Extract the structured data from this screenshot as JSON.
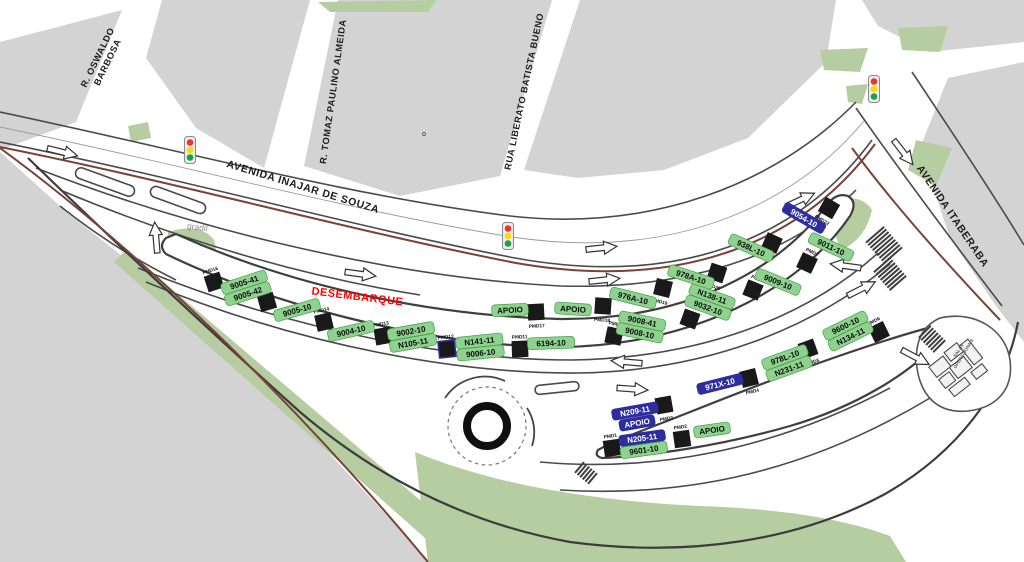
{
  "streets": [
    {
      "id": "oswaldo-barbosa",
      "lines": [
        "R. OSWALDO",
        "BARBOSA"
      ]
    },
    {
      "id": "tomaz-paulino-almeida",
      "lines": [
        "R. TOMAZ PAULINO ALMEIDA"
      ]
    },
    {
      "id": "liberato-batista-bueno",
      "lines": [
        "RUA LIBERATO BATISTA BUENO"
      ]
    },
    {
      "id": "inajar-de-souza",
      "lines": [
        "AVENIDA INAJAR DE SOUZA"
      ]
    },
    {
      "id": "itaberaba",
      "lines": [
        "AVENIDA ITABERABA"
      ]
    }
  ],
  "zones": {
    "desembarque": {
      "label": "DESEMBARQUE",
      "color": "#ff0000"
    },
    "gradil": {
      "label": "gradil"
    },
    "salas_operacionais": {
      "lines": [
        "SALAS",
        "OPERACIONAIS"
      ]
    }
  },
  "platforms": [
    {
      "id": "PMD1",
      "lines": [
        {
          "text": "N205-11",
          "style": "blue"
        },
        {
          "text": "9601-10",
          "style": "green"
        }
      ]
    },
    {
      "id": "PMD2",
      "lines": [
        {
          "text": "APOIO",
          "style": "green"
        }
      ]
    },
    {
      "id": "PMD3",
      "lines": [
        {
          "text": "N209-11",
          "style": "blue"
        },
        {
          "text": "APOIO",
          "style": "blue"
        }
      ]
    },
    {
      "id": "PMD4",
      "lines": [
        {
          "text": "971X-10",
          "style": "blue"
        }
      ]
    },
    {
      "id": "PMD5",
      "lines": [
        {
          "text": "978L-10",
          "style": "green"
        },
        {
          "text": "N231-11",
          "style": "green"
        }
      ]
    },
    {
      "id": "PMD6",
      "lines": [
        {
          "text": "9600-10",
          "style": "green"
        },
        {
          "text": "N134-11",
          "style": "green"
        }
      ]
    },
    {
      "id": "PMD7",
      "lines": [
        {
          "text": "9011-10",
          "style": "green"
        }
      ]
    },
    {
      "id": "PMD8",
      "lines": [
        {
          "text": "9009-10",
          "style": "green"
        }
      ]
    },
    {
      "id": "PMD9",
      "lines": [
        {
          "text": "N138-11",
          "style": "green"
        },
        {
          "text": "9032-10",
          "style": "green"
        }
      ]
    },
    {
      "id": "PMD10",
      "lines": [
        {
          "text": "9008-41",
          "style": "green"
        },
        {
          "text": "9008-10",
          "style": "green"
        }
      ]
    },
    {
      "id": "PMD11",
      "lines": [
        {
          "text": "6194-10",
          "style": "green"
        }
      ]
    },
    {
      "id": "PMD12",
      "frame": "blue",
      "lines": [
        {
          "text": "N141-11",
          "style": "green"
        },
        {
          "text": "9006-10",
          "style": "green"
        }
      ]
    },
    {
      "id": "PMD13",
      "lines": [
        {
          "text": "9002-10",
          "style": "green"
        },
        {
          "text": "N105-11",
          "style": "green"
        }
      ]
    },
    {
      "id": "PMD14",
      "lines": [
        {
          "text": "9004-10",
          "style": "green"
        }
      ]
    },
    {
      "id": "PMD15",
      "lines": [
        {
          "text": "9005-10",
          "style": "green"
        }
      ]
    },
    {
      "id": "PMD16",
      "lines": [
        {
          "text": "9005-41",
          "style": "green"
        },
        {
          "text": "9005-42",
          "style": "green"
        }
      ]
    },
    {
      "id": "PMD17",
      "lines": [
        {
          "text": "APOIO",
          "style": "green"
        }
      ]
    },
    {
      "id": "PMD18",
      "lines": [
        {
          "text": "APOIO",
          "style": "green"
        }
      ]
    },
    {
      "id": "PMD19",
      "lines": [
        {
          "text": "976A-10",
          "style": "green"
        }
      ]
    },
    {
      "id": "PMD20",
      "lines": [
        {
          "text": "978A-10",
          "style": "green"
        }
      ]
    },
    {
      "id": "PMD21",
      "lines": [
        {
          "text": "938L-10",
          "style": "green"
        }
      ]
    },
    {
      "id": "PMD22",
      "lines": [
        {
          "text": "9054-10",
          "style": "blue"
        }
      ]
    }
  ],
  "icons": {
    "traffic_light": "traffic-light-icon",
    "arrow": "direction-arrow-icon"
  },
  "traffic_lights": {
    "count": 3,
    "colors": [
      "#ee3426",
      "#ffd900",
      "#18a344"
    ]
  },
  "colors": {
    "block_grey": "#d3d3d3",
    "green_area": "#b6cda2",
    "green_area_light": "#c3d5b1",
    "road_edge": "#4a4a4a",
    "road_edge_dark": "#3c3c3c",
    "boundary_brown": "#7b4336",
    "label_green_bg": "#8fd18f",
    "label_green_border": "#45a045",
    "label_blue_bg": "#2d2d9f",
    "platform_square": "#191919",
    "desembarque_red": "#ff0000"
  }
}
